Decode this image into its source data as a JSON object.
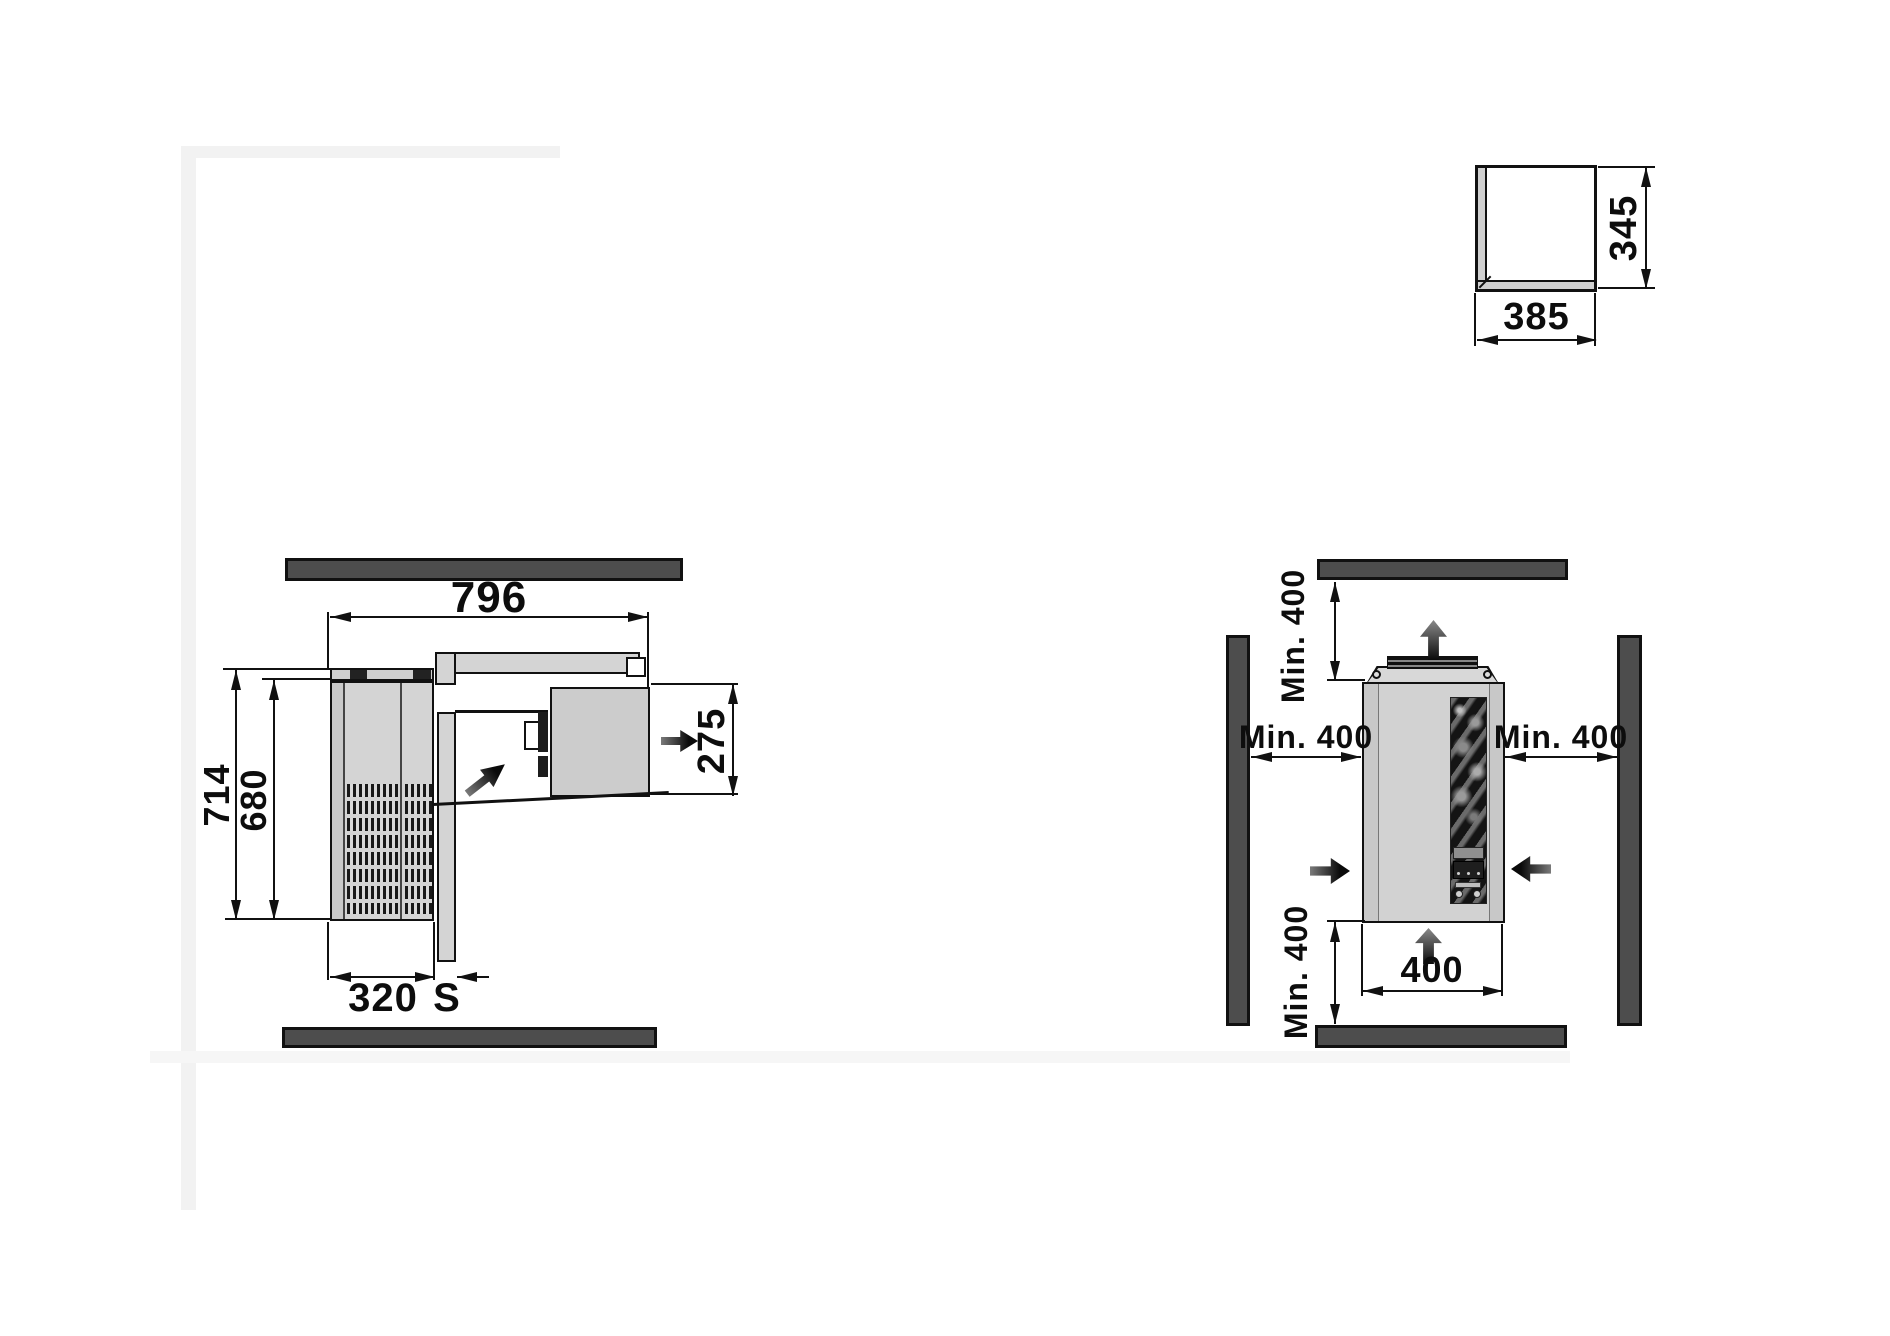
{
  "drawing": {
    "colors": {
      "wall": "#4d4d4d",
      "line": "#111111",
      "panel_light": "#d4d4d4",
      "panel_mid": "#c9c9c9",
      "arrow": "#1a1a1a",
      "background": "#ffffff"
    },
    "plan_view": {
      "width_total": "796",
      "depth_total": "714",
      "depth_inner": "680",
      "condenser_depth": "320",
      "wall_thickness": "S",
      "evaporator_depth": "275"
    },
    "front_view": {
      "clearance_top": "Min. 400",
      "clearance_left": "Min. 400",
      "clearance_right": "Min. 400",
      "clearance_bottom": "Min. 400",
      "unit_width": "400"
    },
    "cutout_detail": {
      "width": "385",
      "height": "345"
    },
    "icons": {
      "airflow_out": "thick-right-arrow",
      "airflow_intake_diagonal": "thick-diagonal-arrow",
      "airflow_up": "thick-up-arrow",
      "airflow_side_in": "thick-side-arrow"
    }
  }
}
